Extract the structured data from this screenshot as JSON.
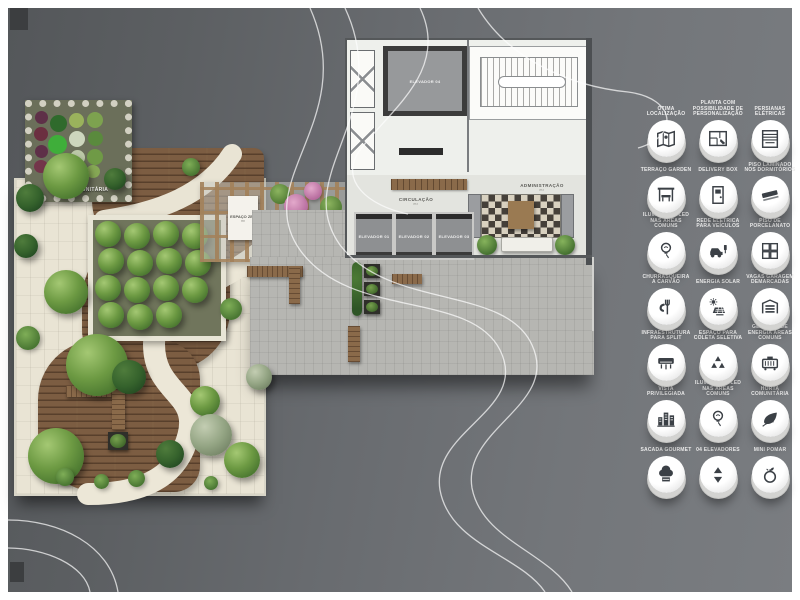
{
  "plan": {
    "horta_label": "HORTA COMUNITÁRIA",
    "pergola_room": {
      "label": "ESPAÇO ZEN",
      "area": "m²"
    },
    "circulacao": {
      "label": "CIRCULAÇÃO",
      "area": "m²"
    },
    "administracao": {
      "label": "ADMINISTRAÇÃO",
      "area": "m²"
    },
    "elevator_top": "ELEVADOR 04",
    "elevators": [
      "ELEVADOR 01",
      "ELEVADOR 02",
      "ELEVADOR 03"
    ]
  },
  "legend": {
    "items": [
      {
        "label": "ÓTIMA LOCALIZAÇÃO",
        "icon": "map-icon",
        "icon_ref": "#i-map"
      },
      {
        "label": "PLANTA COM POSSIBILIDADE DE PERSONALIZAÇÃO",
        "icon": "floorplan-icon",
        "icon_ref": "#i-plan"
      },
      {
        "label": "PERSIANAS ELÉTRICAS",
        "icon": "blinds-icon",
        "icon_ref": "#i-blinds"
      },
      {
        "label": "TERRAÇO GARDEN",
        "icon": "pergola-bench-icon",
        "icon_ref": "#i-pergola"
      },
      {
        "label": "DELIVERY BOX",
        "icon": "delivery-locker-icon",
        "icon_ref": "#i-locker"
      },
      {
        "label": "PISO LAMINADO NOS DORMITÓRIOS",
        "icon": "wood-plank-icon",
        "icon_ref": "#i-plank"
      },
      {
        "label": "ILUMINAÇÃO LED NAS ÁREAS COMUNS",
        "icon": "led-bulb-icon",
        "icon_ref": "#i-bulb"
      },
      {
        "label": "REDE ELÉTRICA PARA VEÍCULOS",
        "icon": "ev-charger-icon",
        "icon_ref": "#i-ev"
      },
      {
        "label": "PISO DE PORCELANATO",
        "icon": "tile-icon",
        "icon_ref": "#i-tile"
      },
      {
        "label": "CHURRASQUEIRA A CARVÃO",
        "icon": "grill-icon",
        "icon_ref": "#i-grill"
      },
      {
        "label": "ENERGIA SOLAR",
        "icon": "solar-panel-icon",
        "icon_ref": "#i-solar"
      },
      {
        "label": "VAGAS GARAGEM DEMARCADAS",
        "icon": "garage-icon",
        "icon_ref": "#i-garage"
      },
      {
        "label": "INFRAESTRUTURA PARA SPLIT",
        "icon": "ac-split-icon",
        "icon_ref": "#i-split"
      },
      {
        "label": "ESPAÇO PARA COLETA SELETIVA",
        "icon": "recycle-icon",
        "icon_ref": "#i-recycle"
      },
      {
        "label": "GERADOR DE ENERGIA ÁREAS COMUNS",
        "icon": "generator-icon",
        "icon_ref": "#i-gen"
      },
      {
        "label": "VISTA PRIVILEGIADA",
        "icon": "skyline-icon",
        "icon_ref": "#i-city"
      },
      {
        "label": "ILUMINAÇÃO LED NAS ÁREAS COMUNS",
        "icon": "led-bulb-icon",
        "icon_ref": "#i-bulb"
      },
      {
        "label": "HORTA COMUNITÁRIA",
        "icon": "leaves-icon",
        "icon_ref": "#i-leaf"
      },
      {
        "label": "SACADA GOURMET",
        "icon": "chef-hat-icon",
        "icon_ref": "#i-chef"
      },
      {
        "label": "04 ELEVADORES",
        "icon": "elevator-arrows-icon",
        "icon_ref": "#i-elev"
      },
      {
        "label": "MINI POMAR",
        "icon": "apple-icon",
        "icon_ref": "#i-apple"
      }
    ]
  },
  "colors": {
    "background_gray": "#6b6e72",
    "deck_wood": "#7c5d42",
    "garden_ground": "#e9e4d4",
    "concrete": "#b6b6b2",
    "tree_green": "#6d9a43",
    "flower_pink": "#c07fae",
    "badge_white": "#ffffff",
    "icon_dark": "#3b4046",
    "contour_line": "#ffffff"
  }
}
